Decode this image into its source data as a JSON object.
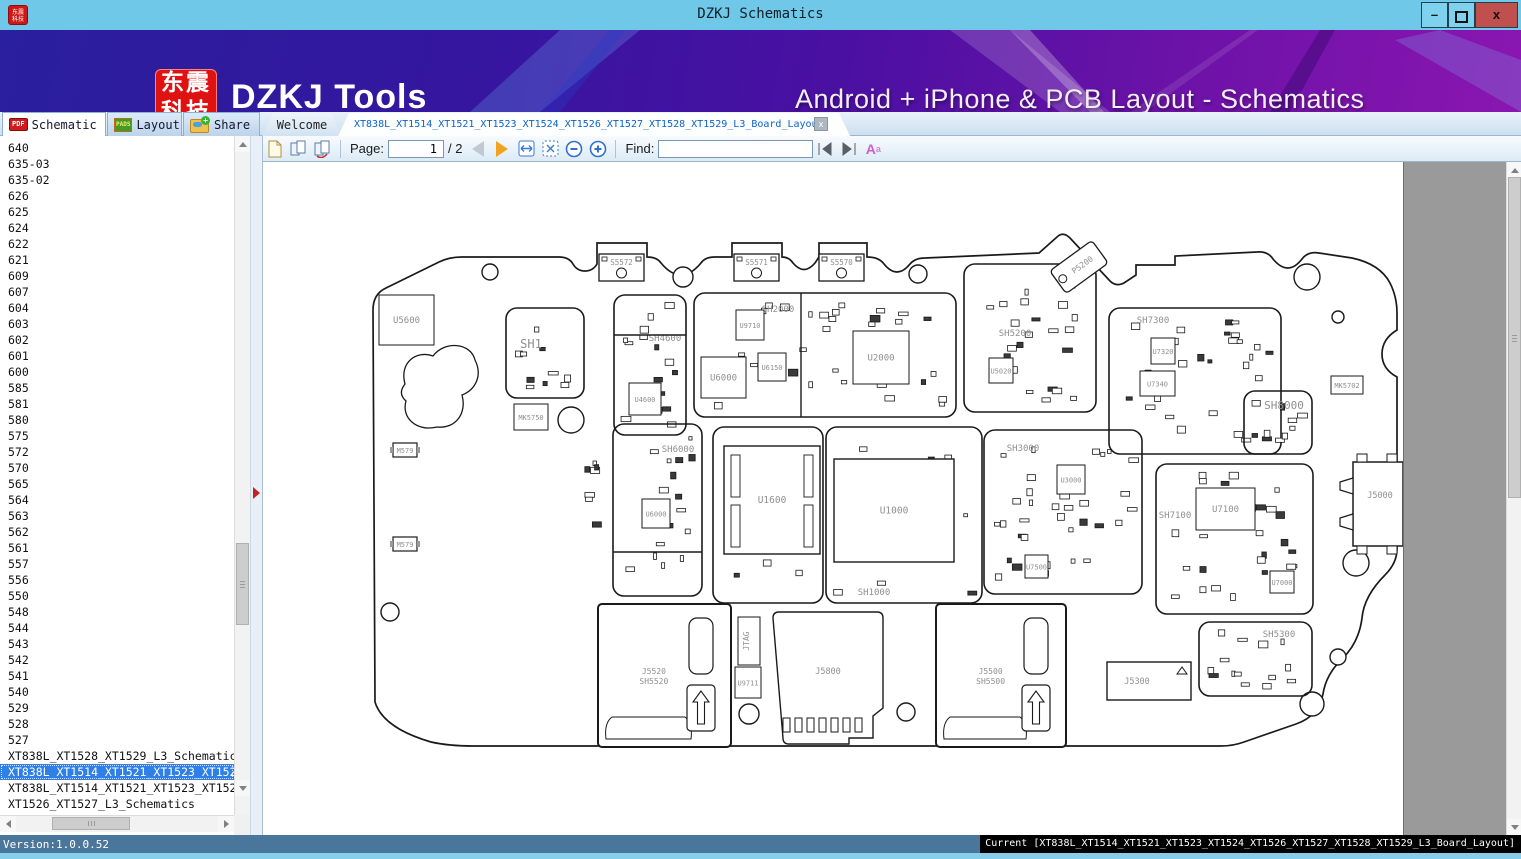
{
  "window": {
    "title": "DZKJ Schematics",
    "min_label": "–",
    "close_label": "x"
  },
  "banner": {
    "logo_line1": "东震",
    "logo_line2": "科技",
    "app_name": "DZKJ Tools",
    "tagline": "Android + iPhone & PCB Layout - Schematics",
    "accent_red": "#e01111",
    "accent_purple": "#4a10a2"
  },
  "tool_tabs": [
    {
      "label": "Schematic",
      "icon": "pdf-icon",
      "active": true
    },
    {
      "label": "Layout",
      "icon": "pads-icon",
      "active": false
    },
    {
      "label": "Share",
      "icon": "share-folder-icon",
      "active": false
    }
  ],
  "doc_tabs": [
    {
      "label": "Welcome",
      "active": false
    },
    {
      "label": "XT838L_XT1514_XT1521_XT1523_XT1524_XT1526_XT1527_XT1528_XT1529_L3_Board_Layout",
      "active": true,
      "close_label": "x"
    }
  ],
  "toolbar": {
    "page_label": "Page:",
    "page_value": "1",
    "page_total": "/ 2",
    "find_label": "Find:",
    "find_value": "",
    "font_button_label": "A",
    "font_button_sup": "a"
  },
  "sidebar": {
    "items": [
      "640",
      "635-03",
      "635-02",
      "626",
      "625",
      "624",
      "622",
      "621",
      "609",
      "607",
      "604",
      "603",
      "602",
      "601",
      "600",
      "585",
      "581",
      "580",
      "575",
      "572",
      "570",
      "565",
      "564",
      "563",
      "562",
      "561",
      "557",
      "556",
      "550",
      "548",
      "544",
      "543",
      "542",
      "541",
      "540",
      "529",
      "528",
      "527"
    ],
    "files": [
      {
        "label": "XT838L_XT1528_XT1529_L3_Schematics",
        "selected": false
      },
      {
        "label": "XT838L_XT1514_XT1521_XT1523_XT1524_XT1",
        "selected": true
      },
      {
        "label": "XT838L_XT1514_XT1521_XT1523_XT1524_XT1",
        "selected": false
      },
      {
        "label": "XT1526_XT1527_L3_Schematics",
        "selected": false
      }
    ]
  },
  "status": {
    "left": "Version:1.0.0.52",
    "right": "Current [XT838L_XT1514_XT1521_XT1523_XT1524_XT1526_XT1527_XT1528_XT1529_L3_Board_Layout]"
  },
  "board": {
    "outline_path": "M 430 742 Q 382 728 374 702 L 372 310 Q 372 294 385 288 L 438 262 Q 448 257 461 257 L 558 257 Q 568 257 572 264 Q 576 271 584 271 Q 592 271 596 264 L 596 243 L 646 243 L 646 257 Q 656 257 660 263 Q 680 287 700 263 Q 704 257 714 257 L 731 257 L 731 243 L 781 243 L 781 257 Q 788 257 792 263 Q 803 276 814 263 L 818 257 L 818 243 L 866 243 L 866 257 Q 878 257 883 264 Q 896 280 909 264 Q 914 258 924 258 L 1038 253 L 1056 237 Q 1062 231 1069 238 L 1109 281 Q 1115 287 1123 283 L 1135 275 L 1135 265 L 1174 265 L 1174 256 L 1256 252 Q 1267 251 1272 259 Q 1287 277 1301 259 Q 1307 251 1318 253 L 1351 258 Q 1379 264 1389 283 Q 1396 297 1396 313 L 1396 330 Q 1381 339 1381 354 Q 1381 369 1396 377 L 1396 549 Q 1396 563 1384 575 Q 1363 596 1361 618 Q 1358 642 1342 658 Q 1325 674 1322 694 Q 1318 716 1295 724 L 1243 742 Q 1232 746 1220 746 L 472 746 Q 448 746 430 742 Z",
    "blob_path": "M 404 384 C 398 362 416 350 432 356 C 444 340 470 343 474 360 C 482 376 474 390 461 395 C 466 413 455 429 436 427 C 416 432 400 418 405 401 C 398 395 400 389 404 384 Z",
    "sections": [
      {
        "label": "SH1",
        "x": 505,
        "y": 308,
        "w": 78,
        "h": 90,
        "lx": 530,
        "ly": 348,
        "fs": 12,
        "scatter": 10
      },
      {
        "label": "SH4600",
        "x": 613,
        "y": 295,
        "w": 72,
        "h": 140,
        "lx": 664,
        "ly": 341,
        "fs": 9,
        "scatter": 16
      },
      {
        "label": "SH2000",
        "x": 693,
        "y": 293,
        "w": 262,
        "h": 124,
        "lx": 777,
        "ly": 312,
        "fs": 9,
        "scatter": 34
      },
      {
        "label": "SH5200",
        "x": 963,
        "y": 264,
        "w": 132,
        "h": 148,
        "lx": 1014,
        "ly": 336,
        "fs": 9,
        "scatter": 22
      },
      {
        "label": "SH7300",
        "x": 1108,
        "y": 308,
        "w": 172,
        "h": 146,
        "lx": 1152,
        "ly": 323,
        "fs": 9,
        "scatter": 30
      },
      {
        "label": "SH8000",
        "x": 1243,
        "y": 391,
        "w": 68,
        "h": 63,
        "lx": 1283,
        "ly": 409,
        "fs": 11,
        "scatter": 8
      },
      {
        "label": "SH3000",
        "x": 983,
        "y": 430,
        "w": 158,
        "h": 164,
        "lx": 1022,
        "ly": 451,
        "fs": 9,
        "scatter": 34
      },
      {
        "label": "SH7100",
        "x": 1155,
        "y": 464,
        "w": 157,
        "h": 150,
        "lx": 1174,
        "ly": 518,
        "fs": 9,
        "scatter": 28
      },
      {
        "label": "SH6000",
        "x": 612,
        "y": 424,
        "w": 89,
        "h": 172,
        "lx": 677,
        "ly": 452,
        "fs": 9,
        "scatter": 16
      },
      {
        "label": "",
        "x": 712,
        "y": 427,
        "w": 110,
        "h": 176,
        "lx": 0,
        "ly": 0,
        "fs": 9,
        "scatter": 8
      },
      {
        "label": "SH1000",
        "x": 825,
        "y": 427,
        "w": 156,
        "h": 176,
        "lx": 873,
        "ly": 595,
        "fs": 9,
        "scatter": 12
      },
      {
        "label": "SH5300",
        "x": 1198,
        "y": 622,
        "w": 113,
        "h": 74,
        "lx": 1278,
        "ly": 637,
        "fs": 9,
        "scatter": 14
      },
      {
        "label": "",
        "x": 575,
        "y": 452,
        "w": 32,
        "h": 84,
        "lx": 0,
        "ly": 0,
        "fs": 9,
        "scatter": 7,
        "noborder": true
      }
    ],
    "dividers": [
      {
        "x1": 613,
        "y1": 335,
        "x2": 685,
        "y2": 335
      },
      {
        "x1": 800,
        "y1": 293,
        "x2": 800,
        "y2": 417
      },
      {
        "x1": 612,
        "y1": 552,
        "x2": 701,
        "y2": 552
      }
    ],
    "chips": [
      {
        "label": "U5600",
        "x": 378,
        "y": 295,
        "w": 55,
        "h": 50
      },
      {
        "label": "MK5750",
        "x": 513,
        "y": 404,
        "w": 34,
        "h": 26
      },
      {
        "label": "U4600",
        "x": 628,
        "y": 383,
        "w": 32,
        "h": 32
      },
      {
        "label": "U9710",
        "x": 735,
        "y": 310,
        "w": 28,
        "h": 30
      },
      {
        "label": "U6000",
        "x": 700,
        "y": 357,
        "w": 45,
        "h": 41
      },
      {
        "label": "U6150",
        "x": 757,
        "y": 353,
        "w": 28,
        "h": 28
      },
      {
        "label": "U2000",
        "x": 852,
        "y": 331,
        "w": 56,
        "h": 53
      },
      {
        "label": "U5020",
        "x": 988,
        "y": 358,
        "w": 24,
        "h": 25
      },
      {
        "label": "U7320",
        "x": 1150,
        "y": 338,
        "w": 24,
        "h": 26
      },
      {
        "label": "U7340",
        "x": 1139,
        "y": 371,
        "w": 35,
        "h": 25
      },
      {
        "label": "MK5702",
        "x": 1330,
        "y": 376,
        "w": 32,
        "h": 18
      },
      {
        "label": "U3000",
        "x": 1056,
        "y": 465,
        "w": 28,
        "h": 29
      },
      {
        "label": "U7500",
        "x": 1024,
        "y": 555,
        "w": 23,
        "h": 23
      },
      {
        "label": "U7100",
        "x": 1195,
        "y": 488,
        "w": 59,
        "h": 42
      },
      {
        "label": "U7000",
        "x": 1269,
        "y": 571,
        "w": 24,
        "h": 22
      },
      {
        "label": "U6000",
        "x": 641,
        "y": 499,
        "w": 28,
        "h": 29
      },
      {
        "label": "U1600",
        "x": 723,
        "y": 446,
        "w": 96,
        "h": 108,
        "big": true,
        "pins": true
      },
      {
        "label": "U1000",
        "x": 833,
        "y": 459,
        "w": 120,
        "h": 103,
        "big": true
      },
      {
        "label": "U9711",
        "x": 734,
        "y": 667,
        "w": 26,
        "h": 31
      },
      {
        "label": "JTAG",
        "x": 737,
        "y": 617,
        "w": 22,
        "h": 48,
        "rot": true
      }
    ],
    "connectors": [
      {
        "label": "S5572",
        "x": 598,
        "y": 254,
        "w": 45,
        "h": 27,
        "type": "rf"
      },
      {
        "label": "S5571",
        "x": 733,
        "y": 254,
        "w": 45,
        "h": 27,
        "type": "rf"
      },
      {
        "label": "S5570",
        "x": 818,
        "y": 254,
        "w": 45,
        "h": 27,
        "type": "rf"
      },
      {
        "label": "P5200",
        "x": 1052,
        "y": 252,
        "w": 52,
        "h": 30,
        "type": "plug"
      },
      {
        "label": "J5000",
        "x": 1352,
        "y": 462,
        "w": 50,
        "h": 84,
        "type": "usb"
      },
      {
        "label": "J5520",
        "label2": "SH5520",
        "x": 597,
        "y": 604,
        "w": 133,
        "h": 143,
        "type": "sim"
      },
      {
        "label": "J5800",
        "x": 772,
        "y": 612,
        "w": 110,
        "h": 126,
        "type": "sd"
      },
      {
        "label": "J5500",
        "label2": "SH5500",
        "x": 935,
        "y": 604,
        "w": 130,
        "h": 143,
        "type": "sim"
      },
      {
        "label": "J5300",
        "x": 1106,
        "y": 662,
        "w": 84,
        "h": 38,
        "type": "edge"
      },
      {
        "label": "M579",
        "x": 392,
        "y": 443,
        "w": 24,
        "h": 14,
        "type": "small"
      },
      {
        "label": "M579",
        "x": 392,
        "y": 537,
        "w": 24,
        "h": 14,
        "type": "small"
      }
    ],
    "holes": [
      {
        "cx": 489,
        "cy": 272,
        "r": 8
      },
      {
        "cx": 682,
        "cy": 277,
        "r": 10
      },
      {
        "cx": 917,
        "cy": 274,
        "r": 9
      },
      {
        "cx": 1306,
        "cy": 277,
        "r": 13
      },
      {
        "cx": 1337,
        "cy": 317,
        "r": 6
      },
      {
        "cx": 570,
        "cy": 420,
        "r": 13
      },
      {
        "cx": 389,
        "cy": 612,
        "r": 9
      },
      {
        "cx": 748,
        "cy": 714,
        "r": 10
      },
      {
        "cx": 905,
        "cy": 712,
        "r": 9
      },
      {
        "cx": 1355,
        "cy": 563,
        "r": 13
      },
      {
        "cx": 1337,
        "cy": 657,
        "r": 8
      },
      {
        "cx": 1311,
        "cy": 704,
        "r": 12
      }
    ]
  }
}
